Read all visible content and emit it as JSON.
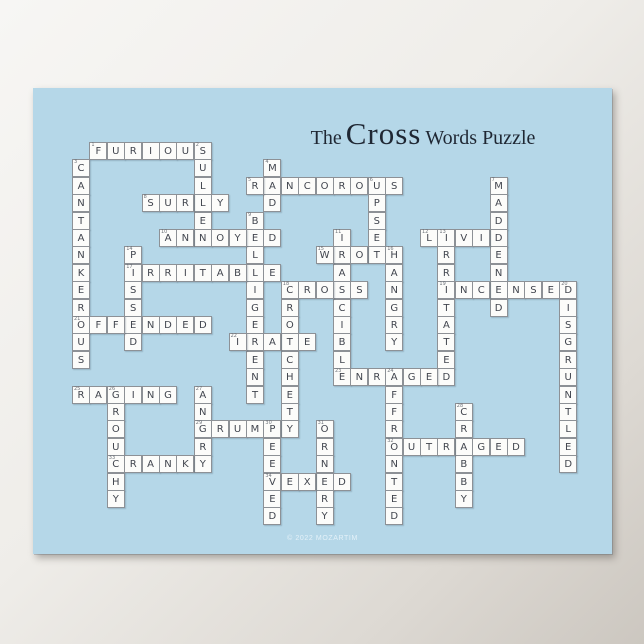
{
  "poster": {
    "title": {
      "prefix": "The",
      "emphasis": "Cross",
      "suffix": "Words Puzzle"
    },
    "footer_credit": "© 2022 MOZARTIM",
    "colors": {
      "poster_background": "#b5d7e8",
      "cell_background": "#fcfcfa",
      "cell_border": "#8d9196",
      "letter_color": "#41454e",
      "number_color": "#6e737a",
      "title_color": "#1f2733",
      "page_background_light": "#f7f6f4",
      "page_background_dark": "#ccc7c0"
    }
  },
  "puzzle": {
    "rows": 22,
    "cols": 29,
    "words": [
      {
        "num": 1,
        "word": "FURIOUS",
        "row": 0,
        "col": 1,
        "dir": "across"
      },
      {
        "num": 2,
        "word": "SULLEN",
        "row": 0,
        "col": 7,
        "dir": "down"
      },
      {
        "num": 3,
        "word": "CANTANKEROUS",
        "row": 1,
        "col": 0,
        "dir": "down"
      },
      {
        "num": 4,
        "word": "MAD",
        "row": 1,
        "col": 11,
        "dir": "down"
      },
      {
        "num": 5,
        "word": "RANCOROUS",
        "row": 2,
        "col": 10,
        "dir": "across"
      },
      {
        "num": 6,
        "word": "UPSET",
        "row": 2,
        "col": 17,
        "dir": "down"
      },
      {
        "num": 7,
        "word": "MADDENED",
        "row": 2,
        "col": 24,
        "dir": "down"
      },
      {
        "num": 8,
        "word": "SURLY",
        "row": 3,
        "col": 4,
        "dir": "across"
      },
      {
        "num": 9,
        "word": "BELLIGERENT",
        "row": 4,
        "col": 10,
        "dir": "down"
      },
      {
        "num": 10,
        "word": "ANNOYED",
        "row": 5,
        "col": 5,
        "dir": "across"
      },
      {
        "num": 11,
        "word": "IRASCIBLE",
        "row": 5,
        "col": 15,
        "dir": "down"
      },
      {
        "num": 12,
        "word": "LIVID",
        "row": 5,
        "col": 20,
        "dir": "across"
      },
      {
        "num": 13,
        "word": "IRRITATED",
        "row": 5,
        "col": 21,
        "dir": "down"
      },
      {
        "num": 14,
        "word": "PISSED",
        "row": 6,
        "col": 3,
        "dir": "down"
      },
      {
        "num": 15,
        "word": "WROTH",
        "row": 6,
        "col": 14,
        "dir": "across"
      },
      {
        "num": 16,
        "word": "HANGRY",
        "row": 6,
        "col": 18,
        "dir": "down"
      },
      {
        "num": 17,
        "word": "IRRITABLE",
        "row": 7,
        "col": 3,
        "dir": "across"
      },
      {
        "num": 18,
        "word": "CROSS",
        "row": 8,
        "col": 12,
        "dir": "across"
      },
      {
        "num": 18,
        "word": "CROTCHETY",
        "row": 8,
        "col": 12,
        "dir": "down"
      },
      {
        "num": 19,
        "word": "INCENSED",
        "row": 8,
        "col": 21,
        "dir": "across"
      },
      {
        "num": 20,
        "word": "DISGRUNTLED",
        "row": 8,
        "col": 28,
        "dir": "down"
      },
      {
        "num": 21,
        "word": "OFFENDED",
        "row": 10,
        "col": 0,
        "dir": "across"
      },
      {
        "num": 22,
        "word": "IRATE",
        "row": 11,
        "col": 9,
        "dir": "across"
      },
      {
        "num": 23,
        "word": "ENRAGED",
        "row": 13,
        "col": 15,
        "dir": "across"
      },
      {
        "num": 24,
        "word": "AFFRONTED",
        "row": 13,
        "col": 18,
        "dir": "down"
      },
      {
        "num": 25,
        "word": "RAGING",
        "row": 14,
        "col": 0,
        "dir": "across"
      },
      {
        "num": 26,
        "word": "GROUCHY",
        "row": 14,
        "col": 2,
        "dir": "down"
      },
      {
        "num": 27,
        "word": "ANGRY",
        "row": 14,
        "col": 7,
        "dir": "down"
      },
      {
        "num": 28,
        "word": "CRABBY",
        "row": 15,
        "col": 22,
        "dir": "down"
      },
      {
        "num": 29,
        "word": "GRUMPY",
        "row": 16,
        "col": 7,
        "dir": "across"
      },
      {
        "num": 30,
        "word": "PEEVED",
        "row": 16,
        "col": 11,
        "dir": "down"
      },
      {
        "num": 31,
        "word": "ORNERY",
        "row": 16,
        "col": 14,
        "dir": "down"
      },
      {
        "num": 32,
        "word": "OUTRAGED",
        "row": 17,
        "col": 18,
        "dir": "across"
      },
      {
        "num": 33,
        "word": "CRANKY",
        "row": 18,
        "col": 2,
        "dir": "across"
      },
      {
        "num": 34,
        "word": "VEXED",
        "row": 19,
        "col": 11,
        "dir": "across"
      }
    ]
  }
}
